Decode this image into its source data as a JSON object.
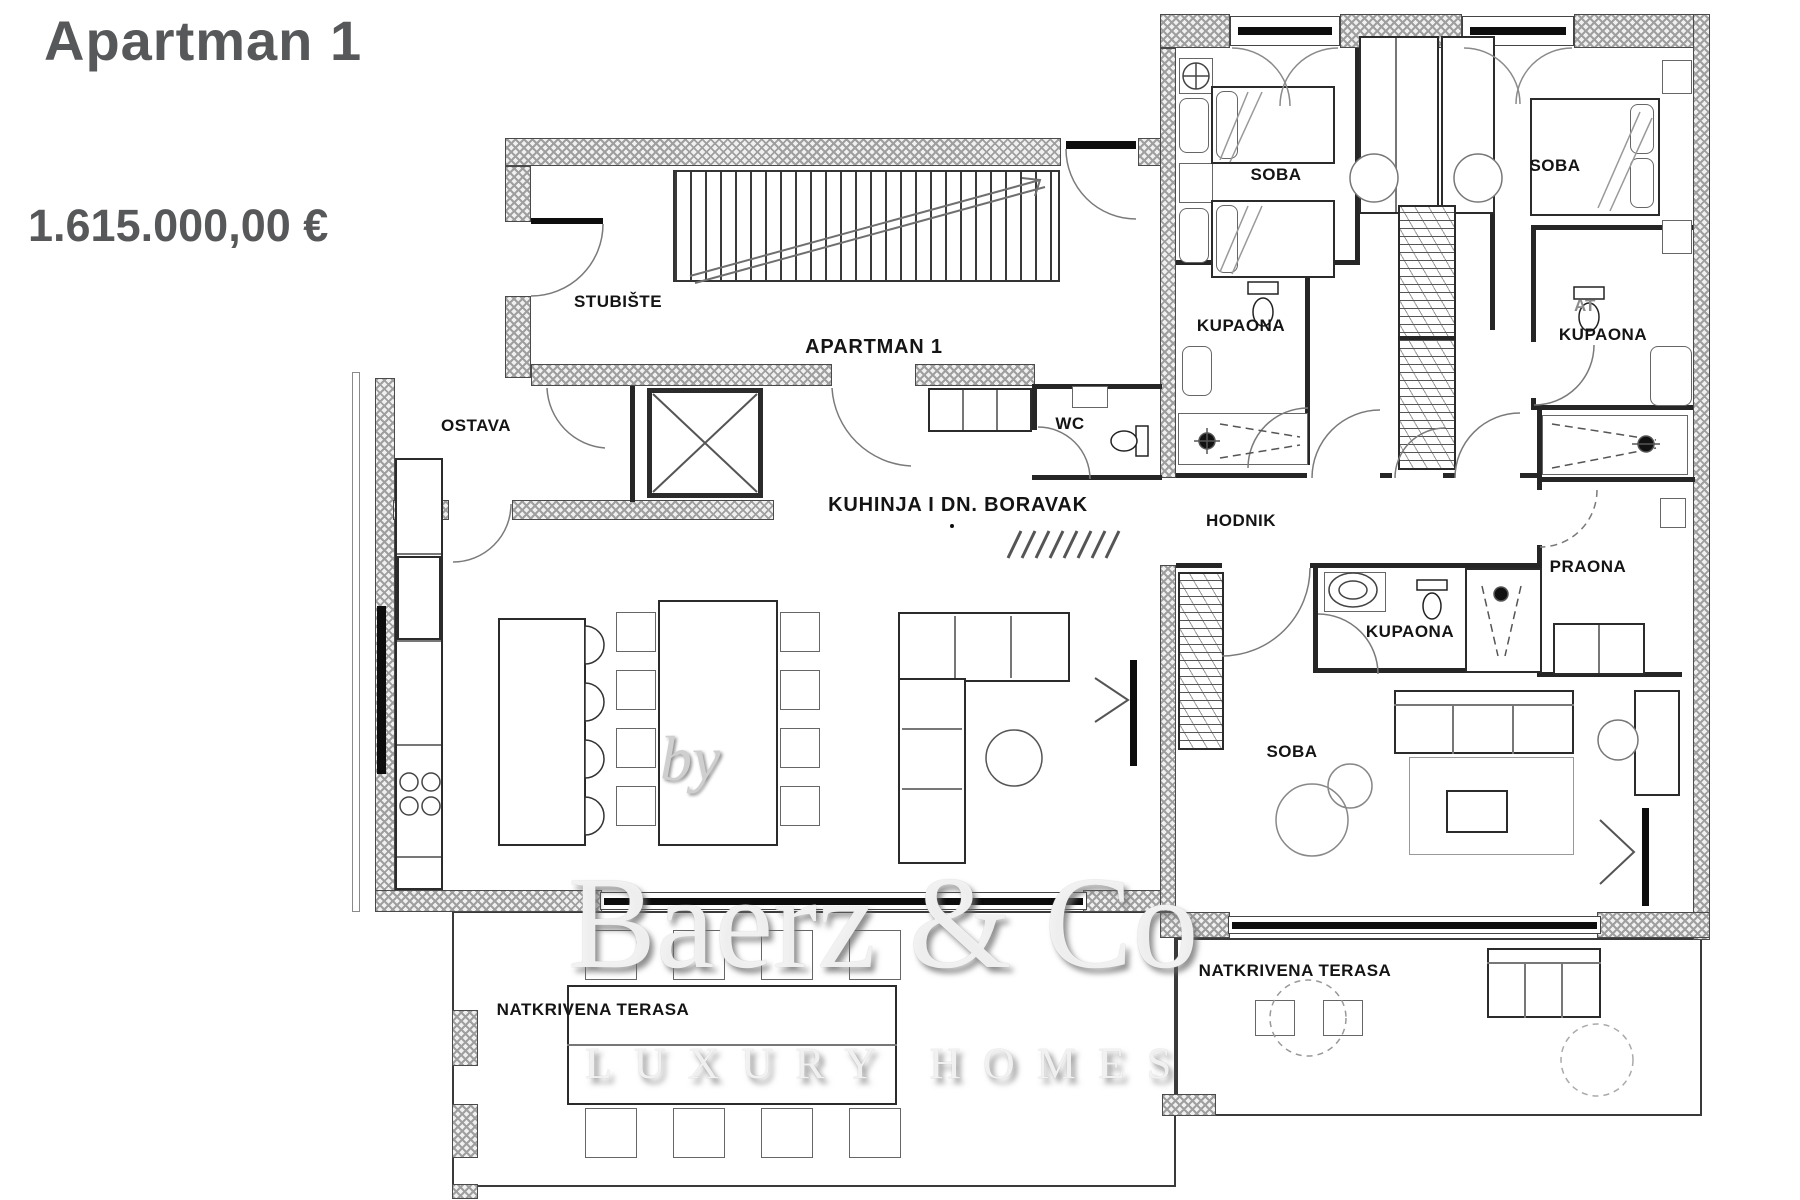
{
  "header": {
    "title": "Apartman 1",
    "price": "1.615.000,00 €"
  },
  "rooms": {
    "stubiste": "STUBIŠTE",
    "apartman": "APARTMAN 1",
    "ostava": "OSTAVA",
    "wc": "WC",
    "kuhinja": "KUHINJA I DN. BORAVAK",
    "hodnik": "HODNIK",
    "praona": "PRAONA",
    "soba1": "SOBA",
    "soba2": "SOBA",
    "soba3": "SOBA",
    "kupaona1": "KUPAONA",
    "kupaona2": "KUPAONA",
    "kupaona3": "KUPAONA",
    "terasa1": "NATKRIVENA TERASA",
    "terasa2": "NATKRIVENA TERASA"
  },
  "watermark": {
    "by": "by",
    "brand": "Baerz & Co",
    "tagline": "LUXURY HOMES",
    "artifact": "AT"
  },
  "colors": {
    "title_text": "#57585a",
    "label_text": "#141414",
    "wall_line": "#4a4a4a",
    "wall_hatch": "#9f9f9f"
  }
}
